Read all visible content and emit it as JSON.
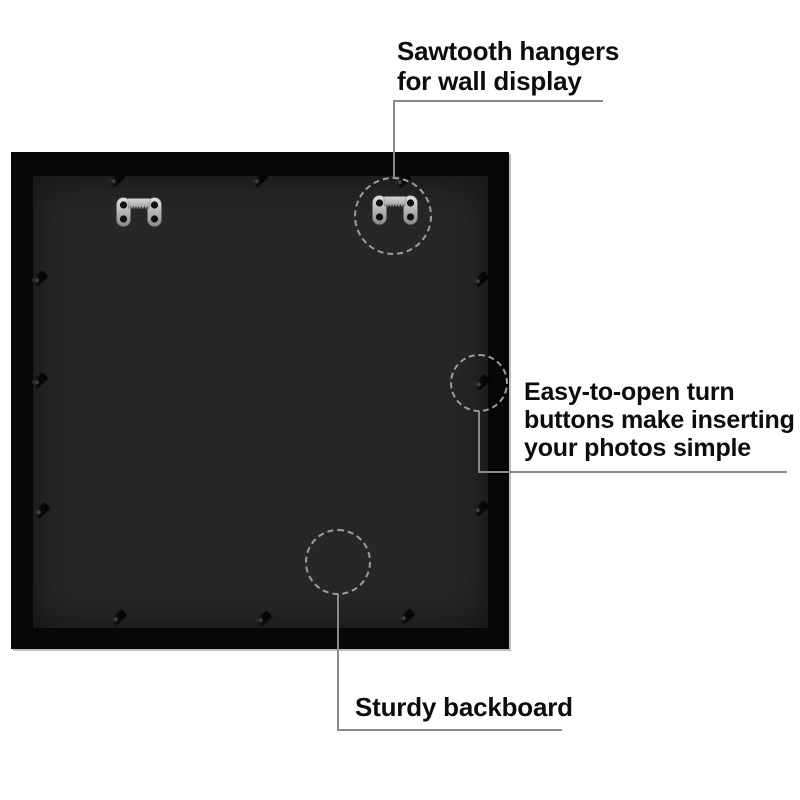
{
  "product": {
    "type": "picture frame back view",
    "frame_color": "#070707",
    "backboard_color": "#272727",
    "hanger_metal_color": "#c9c9c9",
    "sawtooth_hanger_count": 2,
    "turn_button_count": 12
  },
  "callouts": {
    "line_color": "#8a8a8a",
    "circle_color": "#9c9c9c",
    "sawtooth": {
      "text": "Sawtooth hangers\nfor wall display"
    },
    "turn_buttons": {
      "text": "Easy-to-open turn\nbuttons make inserting\nyour photos simple"
    },
    "backboard": {
      "text": "Sturdy backboard"
    }
  }
}
